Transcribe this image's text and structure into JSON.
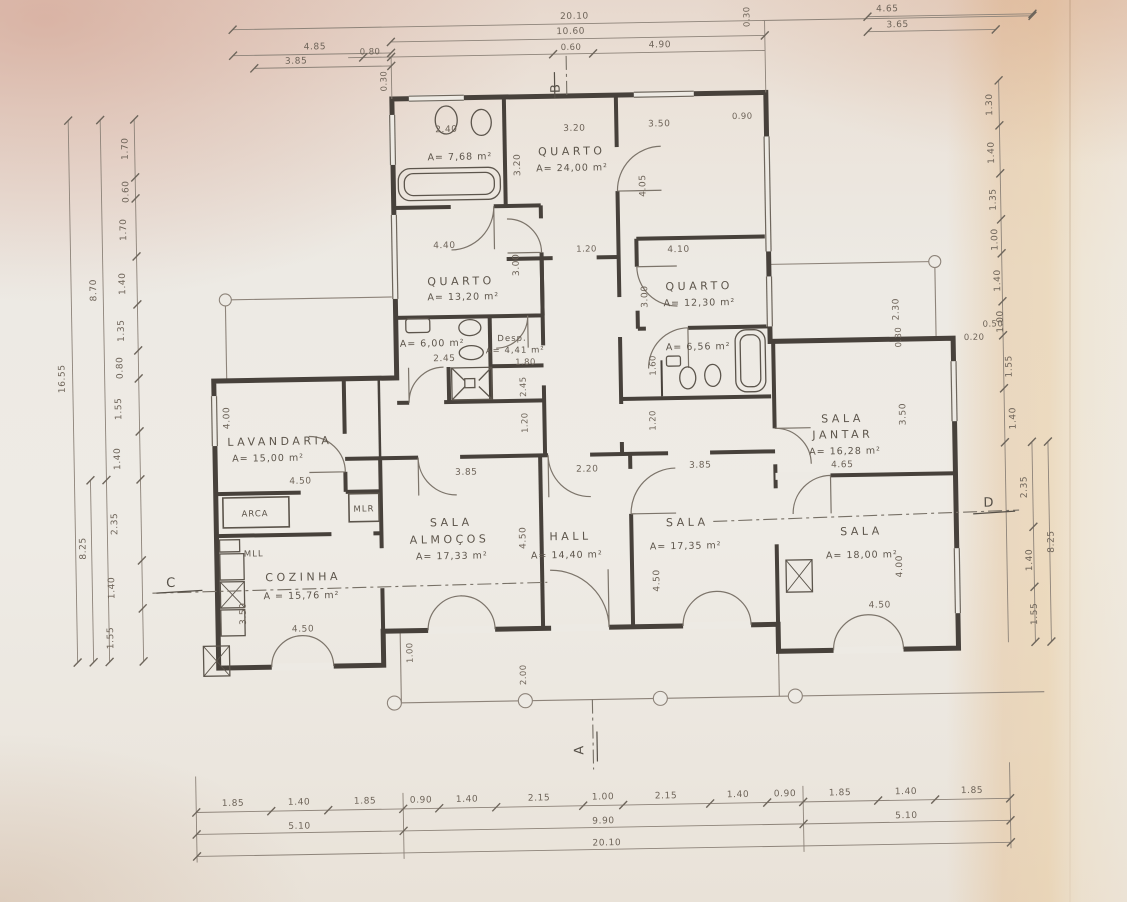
{
  "rooms": {
    "wc1": {
      "area": "A= 7,68 m²",
      "w": "2.40"
    },
    "quarto_top": {
      "name": "QUARTO",
      "area": "A= 24,00 m²",
      "w": "3.20",
      "h": "3.20"
    },
    "quarto_left": {
      "name": "QUARTO",
      "area": "A= 13,20 m²",
      "w": "4.40",
      "h": "3.00"
    },
    "quarto_right": {
      "name": "QUARTO",
      "area": "A= 12,30 m²",
      "w": "4.10",
      "h": "3.00"
    },
    "suite": {
      "w": "3.50",
      "jog": "0.90",
      "h": "4.05"
    },
    "wc2": {
      "area": "A= 6,00 m²",
      "w": "2.45"
    },
    "desp": {
      "name": "Desp.",
      "area": "A= 4,41 m²",
      "w": "1.80",
      "h": "2.45"
    },
    "wc3": {
      "area": "A= 6,56 m²",
      "h": "1.60"
    },
    "lavandaria": {
      "name": "LAVANDARIA",
      "area": "A= 15,00 m²",
      "w": "4.50",
      "h": "4.00"
    },
    "arca": {
      "name": "ARCA"
    },
    "mlr": {
      "name": "MLR"
    },
    "mll": {
      "name": "MLL"
    },
    "cozinha": {
      "name": "COZINHA",
      "area": "A = 15,76 m²",
      "w": "4.50",
      "h": "3.50"
    },
    "sala_almocos": {
      "name": "SALA",
      "name2": "ALMOÇOS",
      "area": "A= 17,33 m²",
      "w": "3.85",
      "h": "4.50"
    },
    "hall": {
      "name": "HALL",
      "area": "A= 14,40 m²",
      "w": "2.20"
    },
    "sala_center": {
      "name": "SALA",
      "area": "A= 17,35 m²",
      "w": "3.85",
      "h": "4.50"
    },
    "sala_jantar": {
      "name": "SALA",
      "name2": "JANTAR",
      "area": "A= 16,28 m²",
      "w": "4.65",
      "h": "3.50"
    },
    "sala_right": {
      "name": "SALA",
      "area": "A= 18,00 m²",
      "w": "4.50",
      "h": "4.00"
    }
  },
  "corridors": {
    "c1": "1.20",
    "c2": "1.20",
    "c3": "1.20",
    "porch_step": "1.00",
    "porch_depth": "2.00"
  },
  "markers": {
    "a": "A",
    "b": "B",
    "c": "C",
    "d": "D"
  },
  "dims": {
    "top": {
      "total": "20.10",
      "mid": "10.60",
      "seg_060": "0.60",
      "seg_490": "4.90",
      "left_485": "4.85",
      "left_385": "3.85",
      "left_080": "0.80",
      "right_465": "4.65",
      "right_365": "3.65",
      "v030_left": "0.30",
      "v030_right": "0.30"
    },
    "bottom": {
      "row1": [
        "1.85",
        "1.40",
        "1.85",
        "0.90",
        "1.40",
        "2.15",
        "1.00",
        "2.15",
        "1.40",
        "0.90",
        "1.85",
        "1.40",
        "1.85"
      ],
      "row2": [
        "5.10",
        "9.90",
        "5.10"
      ],
      "total": "20.10"
    },
    "left": {
      "vals": [
        "1.70",
        "0.60",
        "1.70",
        "1.40",
        "1.35",
        "0.80",
        "1.55",
        "1.40",
        "2.35",
        "1.40",
        "1.55"
      ],
      "mid": "8.70",
      "lower": "8.25",
      "total": "16.55"
    },
    "right": {
      "vals": [
        "1.30",
        "1.40",
        "1.35",
        "1.00",
        "1.40",
        "1.00",
        "1.55",
        "1.40"
      ],
      "lower": [
        "2.35",
        "1.40",
        "1.55"
      ],
      "lower_total": "8.25",
      "jog_a": "0.50",
      "jog_b": "0.20",
      "v230": "2.30",
      "v030": "0.30"
    }
  }
}
